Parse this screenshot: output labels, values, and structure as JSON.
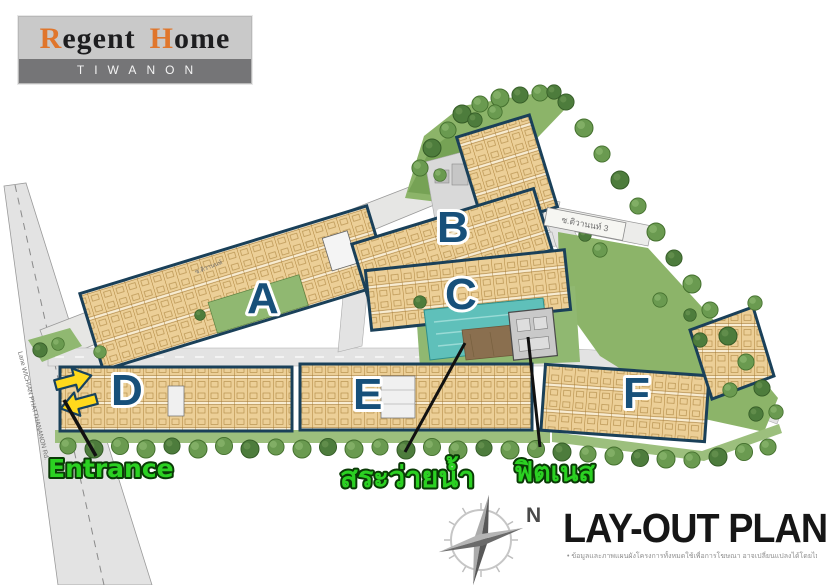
{
  "logo": {
    "r": "R",
    "egent": "egent",
    "h": "H",
    "ome": "ome",
    "subtitle": "TIWANON"
  },
  "buildings": {
    "a": "A",
    "b": "B",
    "c": "C",
    "d": "D",
    "e": "E",
    "f": "F"
  },
  "callouts": {
    "entrance": "Entrance",
    "pool": "สระว่ายน้ำ",
    "fitness": "ฟิตเนส"
  },
  "compass": {
    "north": "N"
  },
  "title": {
    "main": "LAY-OUT PLAN",
    "disclaimer": "• ข้อมูลและภาพแผนผังโครงการทั้งหมดใช้เพื่อการโฆษณา อาจเปลี่ยนแปลงได้โดยไม่ต้องแจ้งให้ทราบล่วงหน้า"
  },
  "roads": {
    "left": "Lane WICHIAN PHATTHANANON Rd.",
    "top": "ซ.ติวานนท์",
    "right": "ซ.ติวานนท์ 3"
  },
  "colors": {
    "brand_orange": "#e0762c",
    "building_outline": "#1a4059",
    "unit_fill": "#eccf97",
    "label_green": "#2bd122",
    "pool_teal": "#5fc0ba",
    "arrow_yellow": "#ffd91c"
  }
}
